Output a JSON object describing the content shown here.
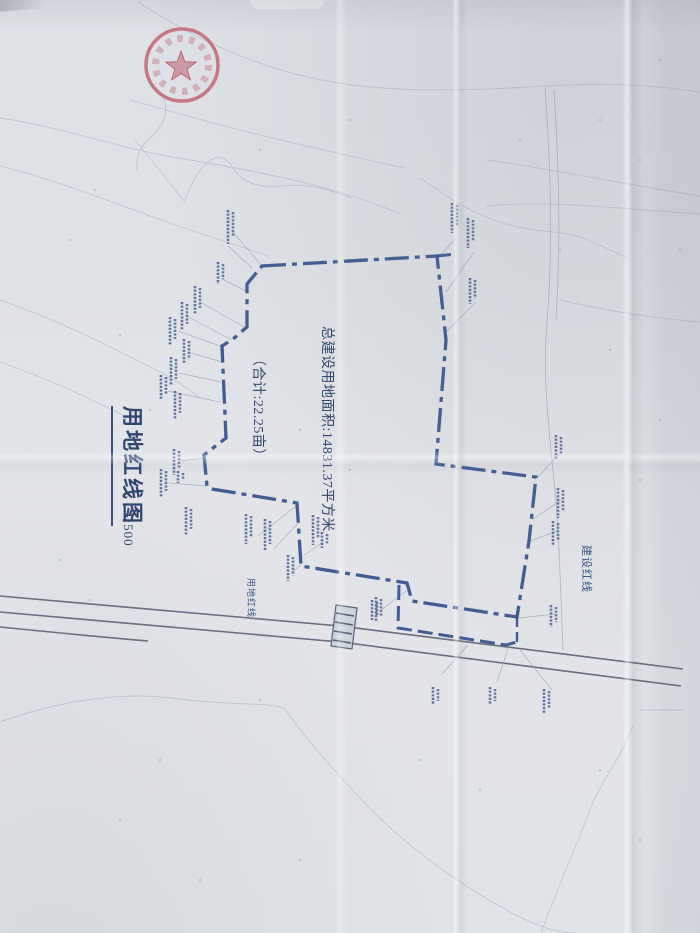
{
  "document": {
    "title": "用地红线图",
    "scale": "1:500",
    "area_line1": "总建设用地面积:14831.37平方米",
    "area_line2": "（合计:22.25亩）",
    "boundary_label": "用地红线",
    "construction_line_label": "建设红线"
  },
  "colors": {
    "boundary": "#34508c",
    "annotation_text": "#31456e",
    "tiny_label": "#4a5d92",
    "road": "#596170",
    "contour": "#b9c0c9",
    "leader": "#9aa2b8",
    "seal_red": "#c05c6c",
    "paper": "#e0e3e7"
  },
  "map": {
    "boundary": {
      "points": "262,266 437,256 446,340 436,464 536,477 529,541 517,617 412,601 407,583 301,566 297,503 212,489 207,486 204,455 226,438 222,346 233,339 247,327 247,284",
      "dash": "24 6 5 6",
      "width": 3.3
    },
    "extra_boundary_lines": [
      {
        "d": "M437,256 L456,254",
        "dash": "14 5",
        "width": 3
      },
      {
        "d": "M399,585 L398,628 L506,645 L517,642",
        "dash": "15 6",
        "width": 3
      },
      {
        "d": "M517,617 L517,642",
        "dash": "10 5",
        "width": 2.4
      }
    ],
    "roads": [
      "M0,596 L340,626 L683,669",
      "M0,612 L340,642 L681,686",
      "M0,627 C50,632 100,637 148,641"
    ],
    "village_road": [
      "M545,88 C551,170 553,250 547,322 C542,384 550,434 556,502 C560,552 561,602 563,650",
      "M554,90 C559,168 561,240 556,320"
    ],
    "culvert": {
      "body": "M336,605 L357,608 L352,649 L331,646 Z",
      "hatch": [
        "M336,613 L354,616",
        "M335,622 L353,625",
        "M334,631 L352,634",
        "M333,640 L351,643"
      ]
    },
    "contours": [
      "M138,2 C200,42 262,70 332,82 C402,94 482,90 547,86 C612,82 662,86 700,92",
      "M0,118 C58,126 118,148 178,158 C238,168 282,176 332,190 C360,198 382,206 400,214",
      "M0,166 C58,180 118,205 178,226 C218,239 248,249 268,256",
      "M130,100 C160,108 200,120 240,130 C280,140 330,152 405,168",
      "M488,160 C545,168 612,182 700,196",
      "M486,206 C545,200 612,208 700,214",
      "M0,722 C60,700 122,692 172,698 C232,706 266,702 284,708 C310,744 332,768 362,800 C402,843 462,888 522,918 C547,930 562,933 576,933",
      "M640,710 L684,710 M633,726 C620,760 601,782 593,802 C581,835 561,880 546,920 L541,933",
      "M0,300 C52,318 102,342 152,368 C172,378 188,388 200,398",
      "M0,362 C52,380 97,402 137,422",
      "M160,92 C172,110 163,126 150,138 C138,148 136,160 137,170",
      "M185,200 C200,160 220,146 233,168 C243,184 260,188 282,186 C310,183 330,190 352,198",
      "M135,140 C160,170 175,190 185,202",
      "M560,300 C602,310 652,318 700,322",
      "M420,178 C452,200 472,214 506,224 C542,234 562,230 582,238 C600,245 615,252 628,258"
    ],
    "leaders": [
      [
        233,
        232,
        262,
        266
      ],
      [
        222,
        279,
        248,
        292
      ],
      [
        200,
        302,
        246,
        328
      ],
      [
        188,
        317,
        232,
        340
      ],
      [
        178,
        331,
        223,
        347
      ],
      [
        191,
        353,
        222,
        362
      ],
      [
        179,
        373,
        221,
        382
      ],
      [
        168,
        391,
        220,
        402
      ],
      [
        181,
        461,
        205,
        458
      ],
      [
        169,
        483,
        206,
        486
      ],
      [
        258,
        536,
        296,
        506
      ],
      [
        274,
        549,
        299,
        522
      ],
      [
        293,
        571,
        301,
        565
      ],
      [
        323,
        542,
        303,
        556
      ],
      [
        380,
        611,
        406,
        591
      ],
      [
        456,
        238,
        438,
        258
      ],
      [
        474,
        252,
        446,
        292
      ],
      [
        476,
        302,
        446,
        332
      ],
      [
        559,
        454,
        538,
        477
      ],
      [
        561,
        500,
        532,
        520
      ],
      [
        557,
        531,
        530,
        541
      ],
      [
        556,
        614,
        519,
        618
      ],
      [
        441,
        675,
        468,
        645
      ],
      [
        497,
        682,
        509,
        646
      ],
      [
        552,
        690,
        520,
        650
      ],
      [
        228,
        246,
        252,
        268
      ]
    ],
    "point_labels": [
      [
        228,
        210,
        34
      ],
      [
        218,
        262,
        22
      ],
      [
        195,
        286,
        28
      ],
      [
        182,
        302,
        28
      ],
      [
        170,
        317,
        28
      ],
      [
        184,
        339,
        24
      ],
      [
        171,
        357,
        28
      ],
      [
        161,
        375,
        24
      ],
      [
        175,
        391,
        28
      ],
      [
        174,
        449,
        26
      ],
      [
        161,
        469,
        28
      ],
      [
        186,
        507,
        28
      ],
      [
        246,
        514,
        30
      ],
      [
        265,
        519,
        32
      ],
      [
        288,
        555,
        26
      ],
      [
        313,
        515,
        30
      ],
      [
        322,
        532,
        16
      ],
      [
        376,
        597,
        24
      ],
      [
        452,
        203,
        30
      ],
      [
        468,
        218,
        30
      ],
      [
        470,
        278,
        26
      ],
      [
        556,
        435,
        24
      ],
      [
        558,
        488,
        30
      ],
      [
        553,
        521,
        24
      ],
      [
        551,
        605,
        22
      ],
      [
        433,
        687,
        18
      ],
      [
        490,
        687,
        18
      ],
      [
        544,
        689,
        24
      ],
      [
        372,
        600,
        20
      ],
      [
        178,
        471,
        12
      ]
    ],
    "spot_marks": [
      [
        95,
        190
      ],
      [
        70,
        240
      ],
      [
        120,
        335
      ],
      [
        150,
        410
      ],
      [
        260,
        150
      ],
      [
        350,
        120
      ],
      [
        520,
        140
      ],
      [
        600,
        120
      ],
      [
        660,
        60
      ],
      [
        640,
        160
      ],
      [
        680,
        250
      ],
      [
        560,
        250
      ],
      [
        610,
        350
      ],
      [
        660,
        420
      ],
      [
        640,
        480
      ],
      [
        300,
        430
      ],
      [
        350,
        470
      ],
      [
        260,
        700
      ],
      [
        160,
        760
      ],
      [
        120,
        820
      ],
      [
        420,
        760
      ],
      [
        480,
        790
      ],
      [
        300,
        860
      ],
      [
        200,
        880
      ],
      [
        640,
        840
      ],
      [
        600,
        770
      ],
      [
        90,
        600
      ],
      [
        60,
        560
      ]
    ],
    "seal": {
      "cx": 182,
      "cy": 65,
      "outer_r": 36,
      "text_ring_r": 26.5,
      "star_points": "181,51 184.8,61.8 196.2,62.1 187.1,69 190.4,79.9 181,73.4 171.6,79.9 174.9,69 165.8,62.1 177.2,61.8"
    }
  }
}
